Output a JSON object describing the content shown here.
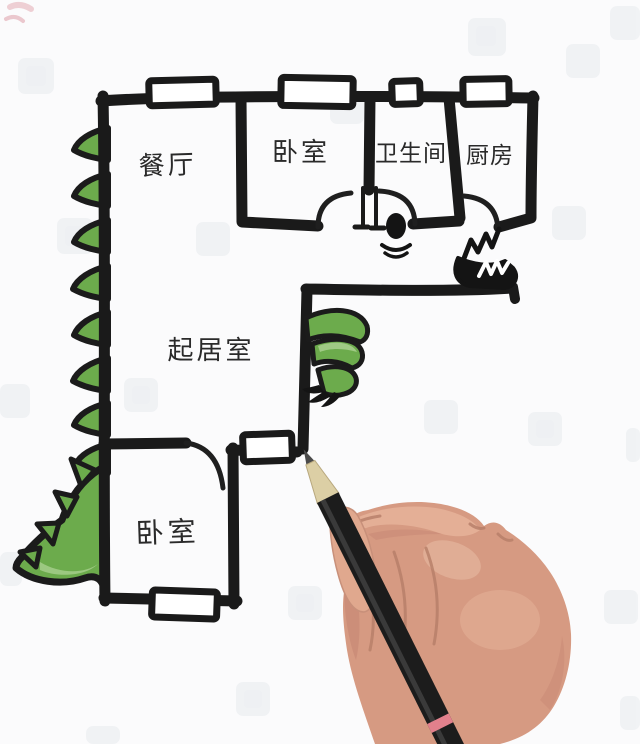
{
  "title": "hand-drawn dinosaur floor plan",
  "rooms": {
    "dining": {
      "label": "餐厅"
    },
    "bedroom_top": {
      "label": "卧室"
    },
    "bathroom": {
      "label": "卫生间"
    },
    "kitchen": {
      "label": "厨房"
    },
    "living": {
      "label": "起居室"
    },
    "bedroom_bottom": {
      "label": "卧室"
    }
  },
  "colors": {
    "wall_black": "#1a1a1a",
    "door_black": "#1f1f1f",
    "dino_green": "#6cab4c",
    "dino_green_light": "#a9cf8f",
    "dino_green_dark": "#4f8a36",
    "skin": "#d69a82",
    "skin_highlight": "#e8b59c",
    "skin_shadow": "#c28270",
    "pencil_body": "#1c1c1c",
    "pencil_wood": "#dccfa5",
    "pencil_band": "#e2808c",
    "label_ink": "#2a2a2a",
    "background": "#fbfbfc",
    "watermark": "#e7ebee"
  }
}
